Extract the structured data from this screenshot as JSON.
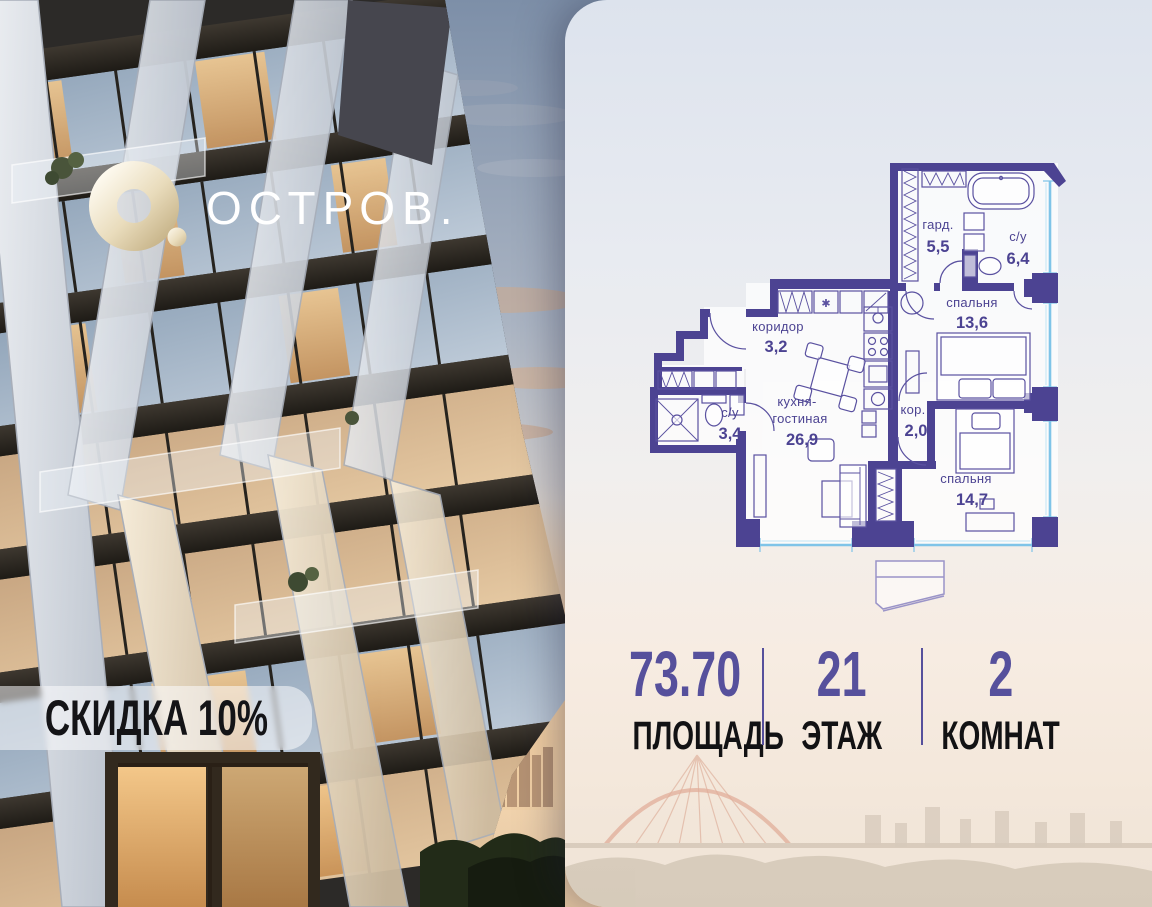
{
  "brand": {
    "name": "ОСТРОВ."
  },
  "badge": {
    "text": "СКИДКА 10%"
  },
  "floorplan": {
    "rooms": [
      {
        "name": "гард.",
        "area": "5,5"
      },
      {
        "name": "с/у",
        "area": "6,4"
      },
      {
        "name": "спальня",
        "area": "13,6"
      },
      {
        "name": "коридор",
        "area": "3,2"
      },
      {
        "name": "кухня-",
        "name2": "гостиная",
        "area": "26,9"
      },
      {
        "name": "с/у",
        "area": "3,4"
      },
      {
        "name": "кор.",
        "area": "2,0"
      },
      {
        "name": "спальня",
        "area": "14,7"
      }
    ],
    "washer_symbol": "✱"
  },
  "stats": {
    "items": [
      {
        "value": "73.70",
        "label": "ПЛОЩАДЬ"
      },
      {
        "value": "21",
        "label": "ЭТАЖ"
      },
      {
        "value": "2",
        "label": "КОМНАТ"
      }
    ]
  },
  "colors": {
    "wall": "#4c4392",
    "window": "#7fc4e8",
    "accent": "#56509c"
  }
}
